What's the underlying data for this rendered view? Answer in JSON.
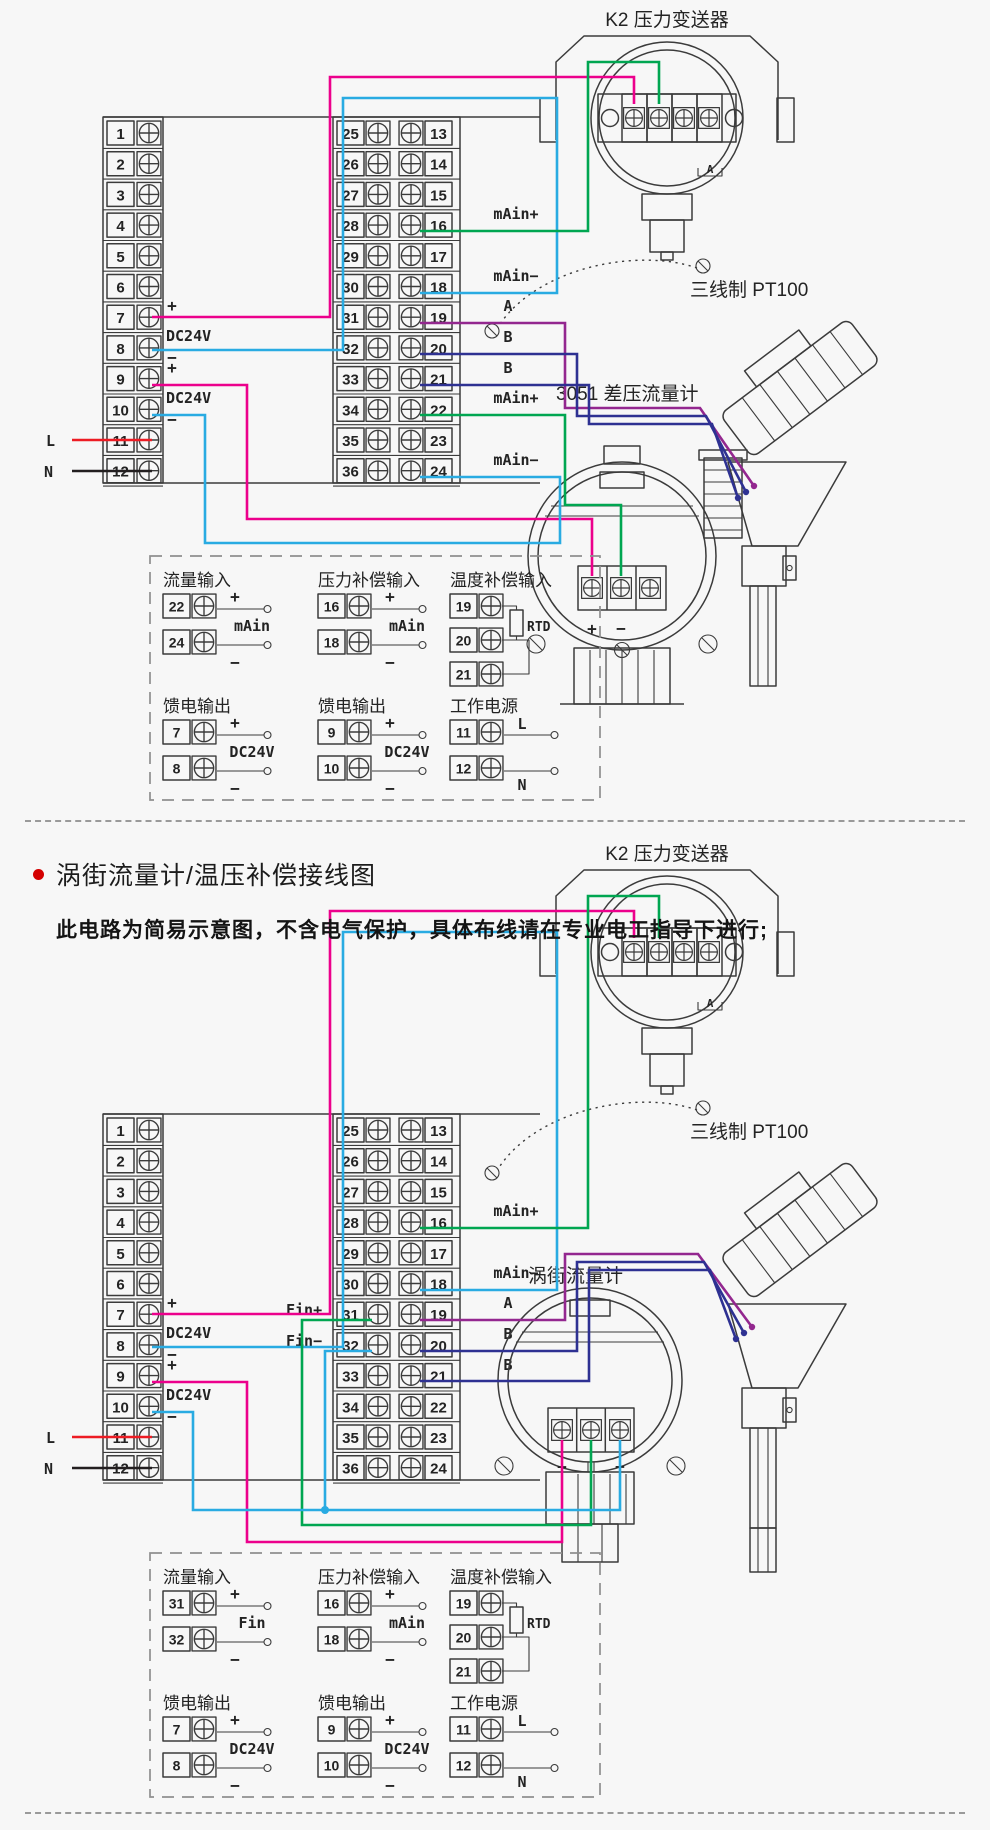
{
  "page": {
    "bg": "#f7f7f7"
  },
  "colors": {
    "magenta": "#ec008c",
    "cyan": "#29abe2",
    "green": "#00a651",
    "purple": "#93278f",
    "navy": "#2e3192",
    "red": "#ed1c24",
    "black": "#231f20",
    "line": "#3b3b3b",
    "bullet": "#d40000"
  },
  "common": {
    "plus": "+",
    "minus": "−",
    "dc24v": "DC24V",
    "l": "L",
    "n": "N",
    "rtd": "RTD"
  },
  "terminal_numbers": {
    "left": [
      "1",
      "2",
      "3",
      "4",
      "5",
      "6",
      "7",
      "8",
      "9",
      "10",
      "11",
      "12"
    ],
    "mid_left": [
      "25",
      "26",
      "27",
      "28",
      "29",
      "30",
      "31",
      "32",
      "33",
      "34",
      "35",
      "36"
    ],
    "mid_right": [
      "13",
      "14",
      "15",
      "16",
      "17",
      "18",
      "19",
      "20",
      "21",
      "22",
      "23",
      "24"
    ]
  },
  "s1": {
    "k2_label": "K2 压力变送器",
    "pt100_label": "三线制 PT100",
    "meter_label": "3051 差压流量计",
    "k2_signs": [
      "+",
      "−",
      "+",
      "−"
    ],
    "k2_letters": [
      "A",
      "B"
    ],
    "k2_bracket_letter": "A",
    "meter_plus": "+",
    "meter_minus": "−",
    "io": {
      "m16": "mAin+",
      "m18": "mAin−",
      "a19": "A",
      "b20": "B",
      "b21": "B",
      "m22": "mAin+",
      "m24": "mAin−"
    },
    "legend": {
      "flow": {
        "title": "流量输入",
        "rows": [
          "22",
          "24"
        ],
        "center": "mAin"
      },
      "press": {
        "title": "压力补偿输入",
        "rows": [
          "16",
          "18"
        ],
        "center": "mAin"
      },
      "temp": {
        "title": "温度补偿输入",
        "rows": [
          "19",
          "20",
          "21"
        ],
        "rtd": "RTD"
      },
      "feed1": {
        "title": "馈电输出",
        "rows": [
          "7",
          "8"
        ],
        "center": "DC24V"
      },
      "feed2": {
        "title": "馈电输出",
        "rows": [
          "9",
          "10"
        ],
        "center": "DC24V"
      },
      "power": {
        "title": "工作电源",
        "rows": [
          "11",
          "12"
        ],
        "l": "L",
        "n": "N"
      }
    }
  },
  "header": {
    "title": "涡街流量计/温压补偿接线图",
    "subtitle": "此电路为简易示意图，不含电气保护，具体布线请在专业电工指导下进行;"
  },
  "s2": {
    "k2_label": "K2 压力变送器",
    "pt100_label": "三线制 PT100",
    "meter_label": "涡街流量计",
    "k2_signs": [
      "+",
      "−",
      "+",
      "−"
    ],
    "k2_letters": [
      "A",
      "B"
    ],
    "k2_bracket_letter": "A",
    "meter_plus": "+",
    "meter_minus": "−",
    "io": {
      "m16": "mAin+",
      "m18": "mAin−",
      "a19": "A",
      "b20": "B",
      "b21": "B",
      "fin_plus": "Fin+",
      "fin_minus": "Fin−"
    },
    "legend": {
      "flow": {
        "title": "流量输入",
        "rows": [
          "31",
          "32"
        ],
        "center": "Fin"
      },
      "press": {
        "title": "压力补偿输入",
        "rows": [
          "16",
          "18"
        ],
        "center": "mAin"
      },
      "temp": {
        "title": "温度补偿输入",
        "rows": [
          "19",
          "20",
          "21"
        ],
        "rtd": "RTD"
      },
      "feed1": {
        "title": "馈电输出",
        "rows": [
          "7",
          "8"
        ],
        "center": "DC24V"
      },
      "feed2": {
        "title": "馈电输出",
        "rows": [
          "9",
          "10"
        ],
        "center": "DC24V"
      },
      "power": {
        "title": "工作电源",
        "rows": [
          "11",
          "12"
        ],
        "l": "L",
        "n": "N"
      }
    }
  }
}
